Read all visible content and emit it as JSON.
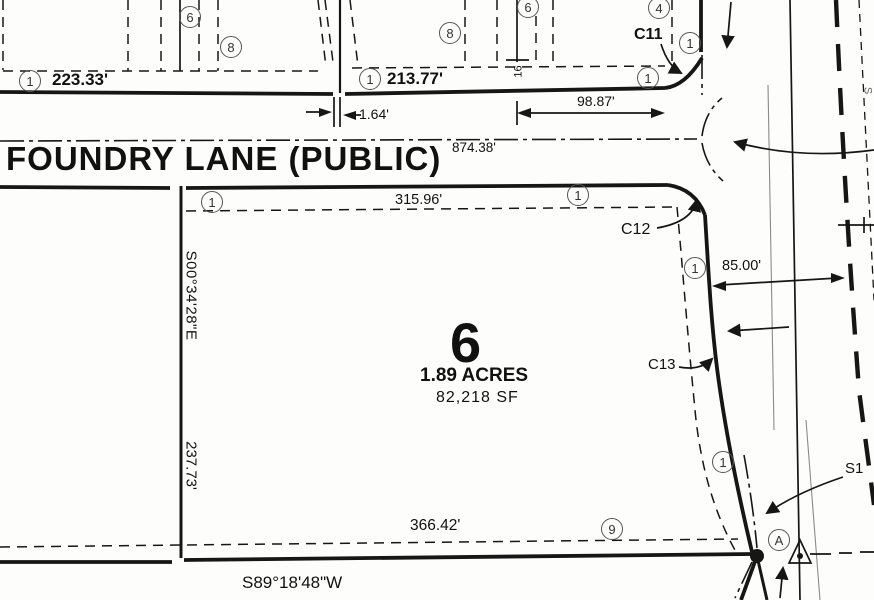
{
  "street": {
    "name": "FOUNDRY LANE (PUBLIC)"
  },
  "lot": {
    "number": "6",
    "area_acres": "1.89 ACRES",
    "area_sf": "82,218 SF"
  },
  "dims": {
    "lot_a_front": "223.33'",
    "lot_b_front": "213.77'",
    "jog": "1.64'",
    "partial_front": "98.87'",
    "centerline_total": "874.38'",
    "north_line": "315.96'",
    "east_offset": "85.00'",
    "west_bearing": "S00°34'28\"E",
    "west_length": "237.73'",
    "south_length": "366.42'",
    "south_bearing": "S89°18'48\"W",
    "easement_width": "16"
  },
  "curve_labels": {
    "c11": "C11",
    "c12": "C12",
    "c13": "C13",
    "s1": "S1"
  },
  "markers": {
    "one": "1",
    "four": "4",
    "six": "6",
    "eight": "8",
    "nine": "9",
    "a": "A"
  },
  "edge_fragment": "S"
}
